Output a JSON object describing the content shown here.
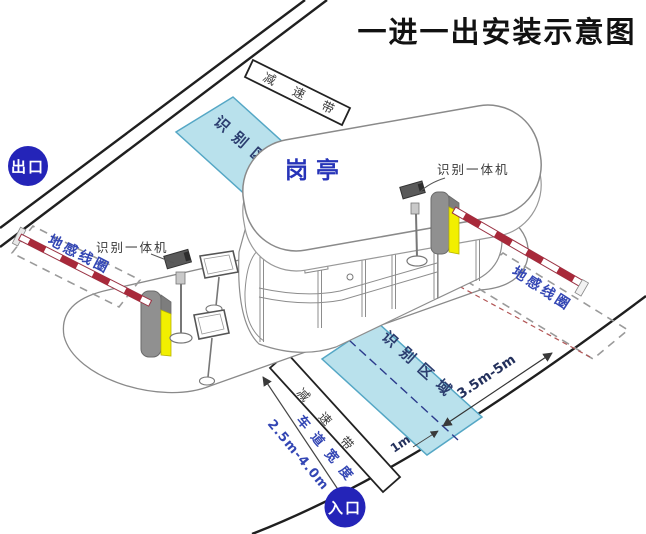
{
  "title": "一进一出安装示意图",
  "badges": {
    "exit": "出口",
    "entrance": "入口"
  },
  "booth": {
    "label": "岗亭"
  },
  "zones": {
    "recognition_top": "识别区域",
    "recognition_bottom": "识别区域",
    "ground_loop_left": "地感线圈",
    "ground_loop_right": "地感线圈"
  },
  "devices": {
    "camera_left_label": "识别一体机",
    "camera_right_label": "识别一体机"
  },
  "road": {
    "speed_bump_top": "减速带",
    "speed_bump_bottom": "减速带",
    "lane_width_label": "车道宽度",
    "lane_width_value": "2.5m-4.0m"
  },
  "measurements": {
    "loop_distance": "3.5m-5m",
    "center_offset": "1m"
  },
  "colors": {
    "badge_blue": "#2424b8",
    "zone_fill": "#b9e1ec",
    "zone_border": "#55a7c5",
    "label_blue": "#3346b4",
    "navy_text": "#23305c",
    "barrier_red": "#a8293a",
    "machine_yellow": "#f2ef00",
    "machine_gray": "#909090",
    "road_line": "#1f1f1f"
  }
}
